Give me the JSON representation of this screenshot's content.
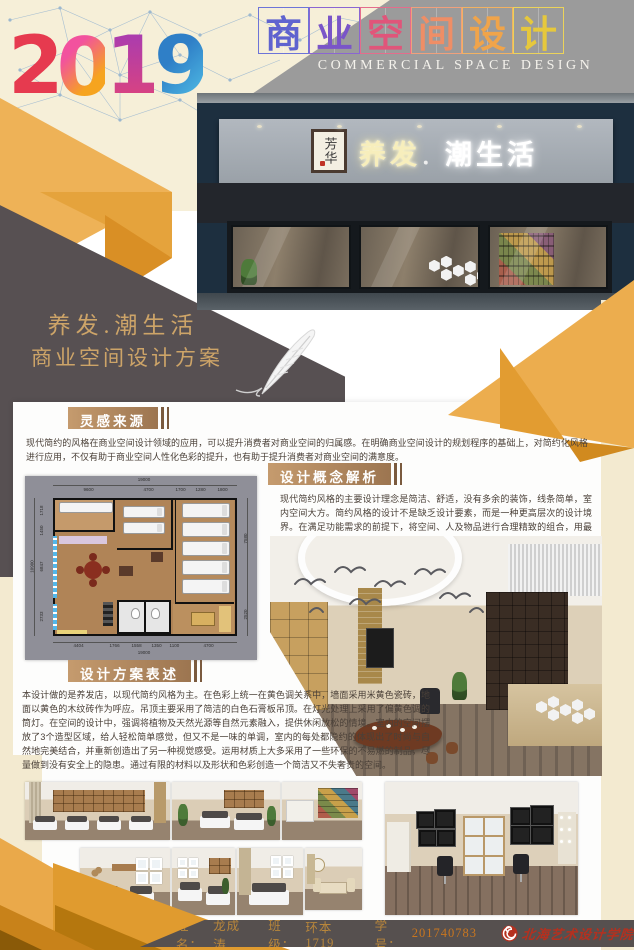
{
  "header": {
    "year": "2019",
    "year_digits": [
      "2",
      "0",
      "1",
      "9"
    ],
    "title_chars": [
      "商",
      "业",
      "空",
      "间",
      "设",
      "计"
    ],
    "subtitle": "COMMERCIAL SPACE DESIGN"
  },
  "storefront": {
    "plaque": "芳华",
    "sign_left": "养发",
    "sign_dot": "．",
    "sign_right": "潮生活"
  },
  "poster_title": {
    "line1": "养发.潮生活",
    "line2": "商业空间设计方案"
  },
  "sections": {
    "inspiration": {
      "heading": "灵感来源",
      "body": "现代简约的风格在商业空间设计领域的应用，可以提升消费者对商业空间的归属感。在明确商业空间设计的规划程序的基础上，对简约化风格进行应用，不仅有助于商业空间人性化色彩的提升，也有助于提升消费者对商业空间的满意度。"
    },
    "concept": {
      "heading": "设计概念解析",
      "body": "现代简约风格的主要设计理念是简洁、舒适，没有多余的装饰，线条简单，室内空间大方。简约风格的设计不是缺乏设计要素，而是一种更高层次的设计境界。在满足功能需求的前提下，将空间、人及物品进行合理精致的组合，用最洗练的笔画，描绘出最简洁素雅的空间效果，这是设计艺术的最高境界。"
    },
    "statement": {
      "heading": "设计方案表述",
      "body": "本设计做的是养发店，以现代简约风格为主。在色彩上统一在黄色调关系中，墙面采用米黄色瓷砖，地面以黄色的木纹砖作为呼应。吊顶主要采用了简洁的白色石膏板吊顶。在灯光处理上采用了偏黄色调的筒灯。在空间的设计中，强调将植物及天然光源等自然元素融入，提供休闲放松的情境。室内的空间摆放了3个造型区域，给人轻松简单感觉，但又不是一味的单调，室内的每处都隐约的体现出了时尚与自然地完美结合，并重新创造出了另一种视觉感受。运用材质上大多采用了一些环保的不易燃的制品，尽量做到没有安全上的隐患。通过有限的材料以及形状和色彩创造一个简洁又不失奢贵的空间。"
    }
  },
  "floor_plan": {
    "top_total": "19000",
    "top_dims": [
      "9600",
      "4700",
      "1700",
      "1280",
      "1800"
    ],
    "bottom_dims": [
      "4404",
      "1766",
      "1558",
      "1350",
      "1100",
      "4700"
    ],
    "bottom_total": "19000",
    "left_total": "10900",
    "left_dims": [
      "1718",
      "1450",
      "6847",
      "2733"
    ],
    "right_dims": [
      "7580",
      "2520"
    ]
  },
  "footer": {
    "name_label": "姓名：",
    "name_value": "龙成涛",
    "class_label": "班级：",
    "class_value": "环本1719",
    "id_label": "学号：",
    "id_value": "201740783",
    "school": "北海艺术设计学院"
  },
  "colors": {
    "amber": "#E8A33B",
    "amber_light": "#EEB257",
    "amber_dark": "#C9831B",
    "dark_panel": "#575052",
    "cream": "#F6EFD8",
    "navy": "#1D2F3F",
    "gold_text": "#CDA468",
    "label_brown": "#A87C52",
    "seal_red": "#B5301F"
  }
}
